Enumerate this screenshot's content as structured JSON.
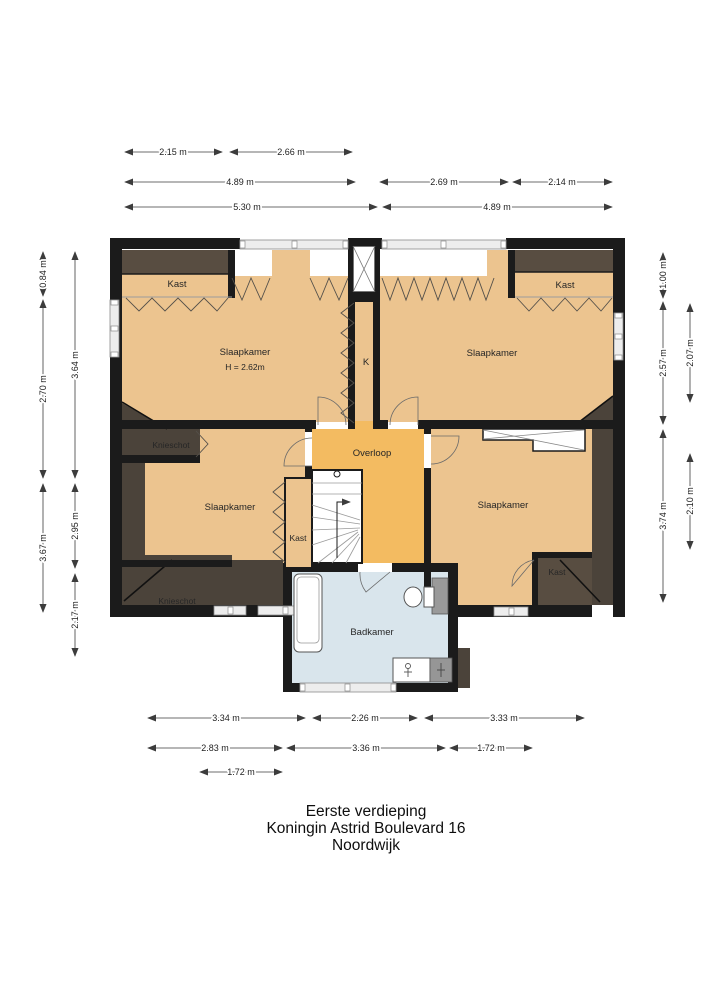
{
  "title": {
    "floor": "Eerste verdieping",
    "address": "Koningin Astrid Boulevard 16",
    "city": "Noordwijk"
  },
  "rooms": {
    "bedroom_top_left": {
      "label": "Slaapkamer",
      "ceiling_height": "H = 2.62m"
    },
    "bedroom_top_right": {
      "label": "Slaapkamer"
    },
    "bedroom_mid_left": {
      "label": "Slaapkamer"
    },
    "bedroom_bottom_right": {
      "label": "Slaapkamer"
    },
    "closet_top_left": {
      "label": "Kast"
    },
    "closet_top_right": {
      "label": "Kast"
    },
    "closet_by_stairs": {
      "label": "Kast"
    },
    "closet_bottom_right": {
      "label": "Kast"
    },
    "duct": {
      "label": "K"
    },
    "landing": {
      "label": "Overloop"
    },
    "bathroom": {
      "label": "Badkamer"
    },
    "kneewall_upper": {
      "label": "Knieschot"
    },
    "kneewall_lower": {
      "label": "Knieschot"
    }
  },
  "dimensions": {
    "top_row1": [
      "2.15 m",
      "2.66 m"
    ],
    "top_row2": [
      "4.89 m",
      "2.69 m",
      "2.14 m"
    ],
    "top_row3": [
      "5.30 m",
      "4.89 m"
    ],
    "bottom_row1": [
      "3.34 m",
      "2.26 m",
      "3.33 m"
    ],
    "bottom_row2": [
      "2.83 m",
      "3.36 m",
      "1.72 m"
    ],
    "bottom_row3": [
      "1.72 m"
    ],
    "left_outer": [
      "0.84 m",
      "2.70 m",
      "3.67 m"
    ],
    "left_inner": [
      "3.64 m",
      "2.95 m",
      "2.17 m"
    ],
    "right_inner": [
      "1.00 m",
      "2.57 m",
      "3.74 m"
    ],
    "right_outer": [
      "2.07 m",
      "2.10 m"
    ]
  },
  "colors": {
    "room": "#ecc48f",
    "landing": "#f3bb61",
    "bathroom": "#d9e5ec",
    "slope": "#4b433a",
    "wall": "#1b1b1b"
  }
}
